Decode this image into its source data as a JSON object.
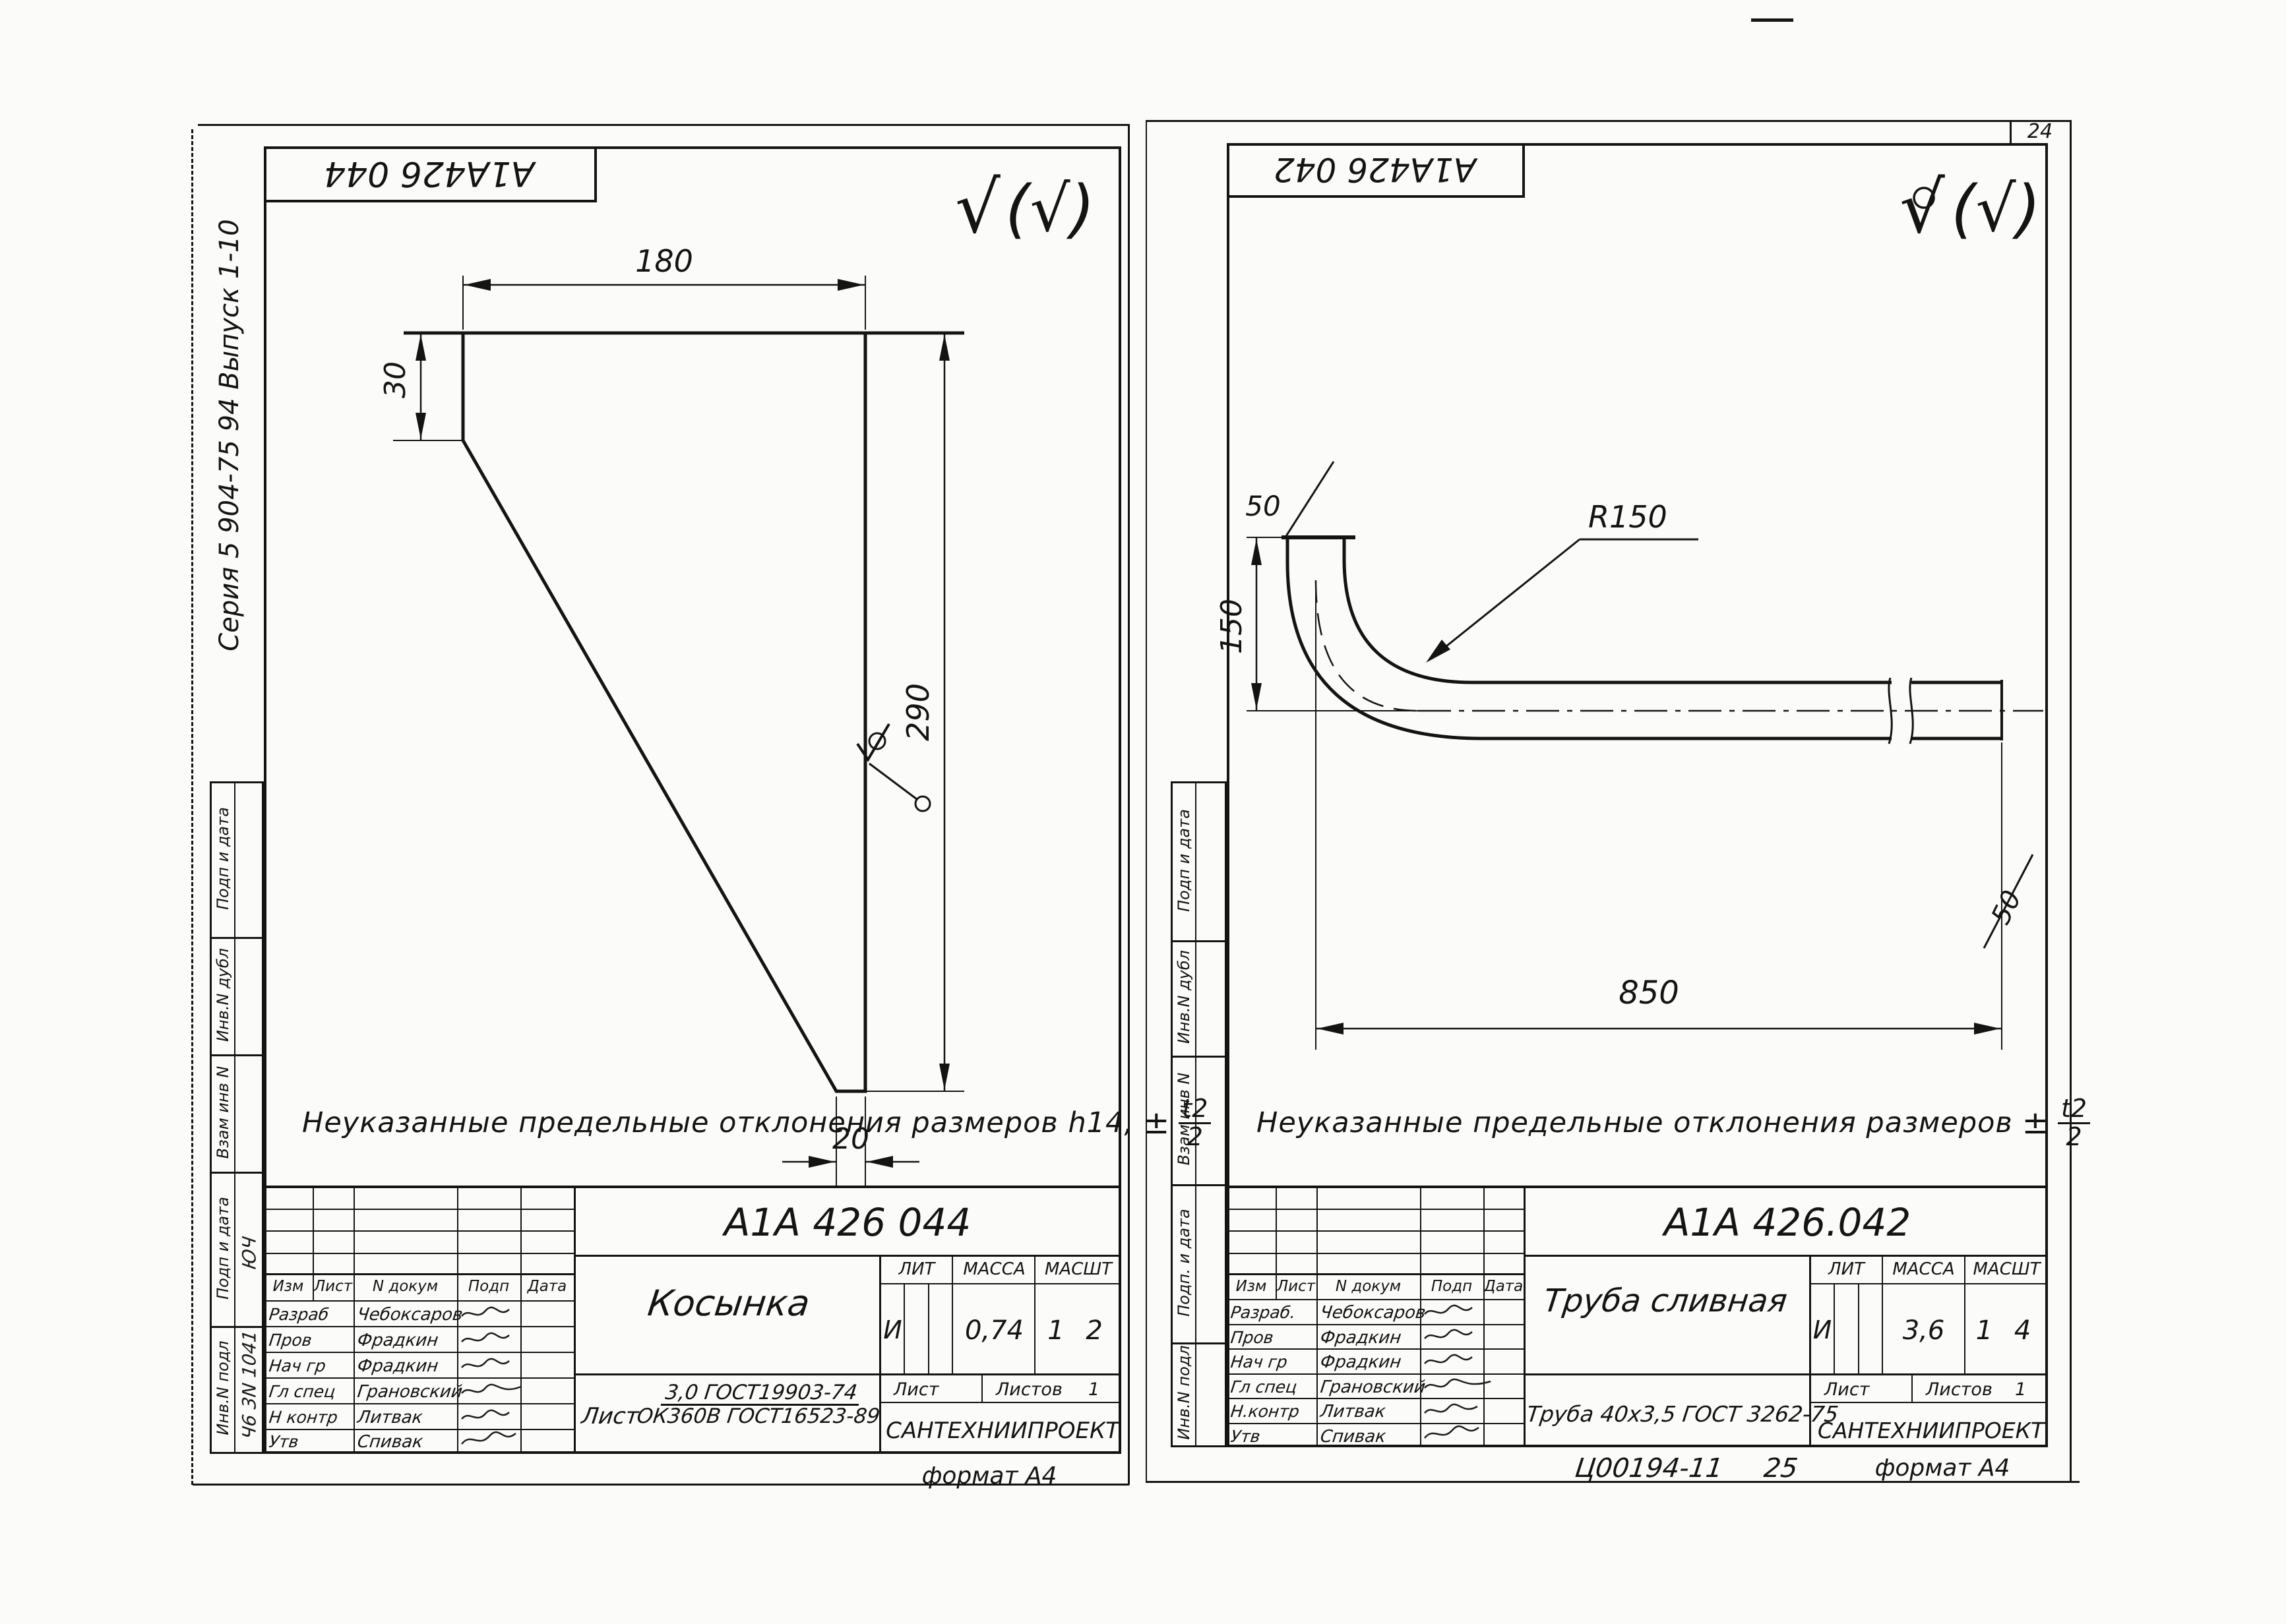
{
  "page": {
    "sheet_number": "24"
  },
  "left_sheet": {
    "code_stamp": "А1А426 044",
    "series_label": "Серия 5 904-75 94        Выпуск 1-10",
    "finish_check": "√",
    "finish_paren": "(√)",
    "dims": {
      "top": "180",
      "left": "30",
      "right": "290",
      "bottom": "20"
    },
    "note": {
      "text": "Неуказанные  предельные  отклонения  размеров  h14,",
      "pm": "±",
      "frac_num": "t2",
      "frac_den": "2"
    },
    "margin_labels": [
      "Подп и дата",
      "Инв.N дубл",
      "Взам инв N",
      "Подп и дата",
      "Инв.N подл"
    ],
    "margin_hand": {
      "upper": "ЮЧ",
      "lower": "Ч6 3N 1041"
    },
    "title_block": {
      "code": "А1А 426 044",
      "lit_h": "ЛИТ",
      "mass_h": "МАССА",
      "scale_h": "МАСШТ",
      "lit": "И",
      "mass": "0,74",
      "scale": "1 2",
      "sheet_h": "Лист",
      "sheets_h": "Листов",
      "sheets_n": "1",
      "name": "Косынка",
      "material_prefix": "Лист",
      "material_num": "3,0 ГОСТ19903-74",
      "material_den": "ОК360В ГОСТ16523-89",
      "org": "САНТЕХНИИПРОЕКТ",
      "sign_header": [
        "Изм",
        "Лист",
        "N докум",
        "Подп",
        "Дата"
      ],
      "rows": [
        {
          "role": "Разраб",
          "name": "Чебоксаров"
        },
        {
          "role": "Пров",
          "name": "Фрадкин"
        },
        {
          "role": "Нач гр",
          "name": "Фрадкин"
        },
        {
          "role": "Гл спец",
          "name": "Грановский"
        },
        {
          "role": "Н контр",
          "name": "Литвак"
        },
        {
          "role": "Утв",
          "name": "Спивак"
        }
      ]
    },
    "format_label": "формат А4"
  },
  "right_sheet": {
    "code_stamp": "А1А426 042",
    "finish_check": "√",
    "finish_paren": "(√)",
    "dims": {
      "radius": "R150",
      "top_chamfer": "50",
      "height": "150",
      "length": "850",
      "end_chamfer": "50"
    },
    "note": {
      "text": "Неуказанные  предельные  отклонения  размеров",
      "pm": "±",
      "frac_num": "t2",
      "frac_den": "2"
    },
    "margin_labels": [
      "Подп и дата",
      "Инв.N дубл",
      "Взам инв N",
      "Подп. и дата",
      "Инв.N подл"
    ],
    "title_block": {
      "code": "А1А 426.042",
      "lit_h": "ЛИТ",
      "mass_h": "МАССА",
      "scale_h": "МАСШТ",
      "lit": "И",
      "mass": "3,6",
      "scale": "1 4",
      "sheet_h": "Лист",
      "sheets_h": "Листов",
      "sheets_n": "1",
      "name": "Труба сливная",
      "material": "Труба 40х3,5 ГОСТ 3262-75",
      "org": "САНТЕХНИИПРОЕКТ",
      "sign_header": [
        "Изм",
        "Лист",
        "N докум",
        "Подп",
        "Дата"
      ],
      "rows": [
        {
          "role": "Разраб.",
          "name": "Чебоксаров"
        },
        {
          "role": "Пров",
          "name": "Фрадкин"
        },
        {
          "role": "Нач гр",
          "name": "Фрадкин"
        },
        {
          "role": "Гл спец",
          "name": "Грановский"
        },
        {
          "role": "Н.контр",
          "name": "Литвак"
        },
        {
          "role": "Утв",
          "name": "Спивак"
        }
      ]
    },
    "footer": {
      "doc": "Ц00194-11",
      "page": "25",
      "format": "формат А4"
    }
  }
}
